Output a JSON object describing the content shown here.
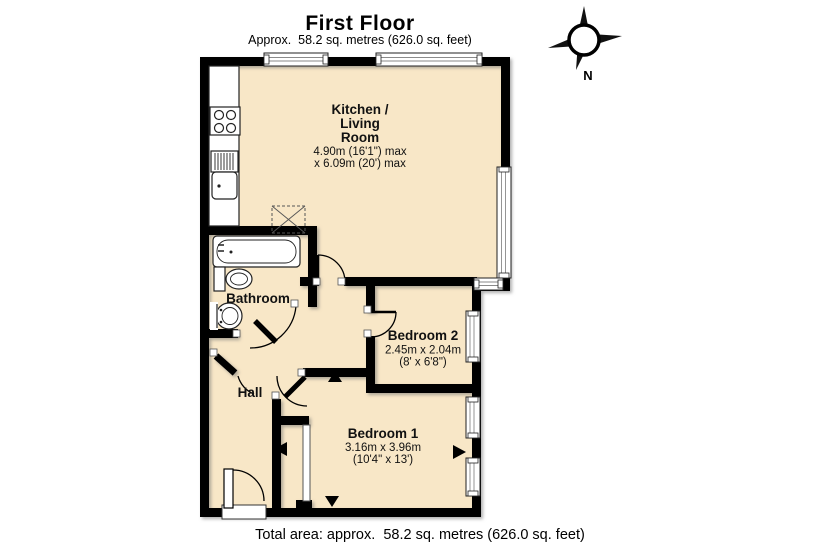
{
  "header": {
    "title": "First Floor",
    "subtitle": "Approx.  58.2 sq. metres (626.0 sq. feet)"
  },
  "compass": {
    "north_label": "N"
  },
  "rooms": {
    "kitchen_living": {
      "name_line1": "Kitchen /",
      "name_line2": "Living",
      "name_line3": "Room",
      "dim_line1": "4.90m (16'1\") max",
      "dim_line2": "x 6.09m (20') max"
    },
    "bathroom": {
      "name": "Bathroom"
    },
    "bedroom2": {
      "name": "Bedroom 2",
      "dim_line1": "2.45m x 2.04m",
      "dim_line2": "(8' x 6'8\")"
    },
    "hall": {
      "name": "Hall"
    },
    "bedroom1": {
      "name": "Bedroom 1",
      "dim_line1": "3.16m x 3.96m",
      "dim_line2": "(10'4\" x 13')"
    }
  },
  "footer": {
    "total_area": "Total area: approx.  58.2 sq. metres (626.0 sq. feet)"
  },
  "colors": {
    "floor_fill": "#f8e7c7",
    "wall": "#000000"
  }
}
